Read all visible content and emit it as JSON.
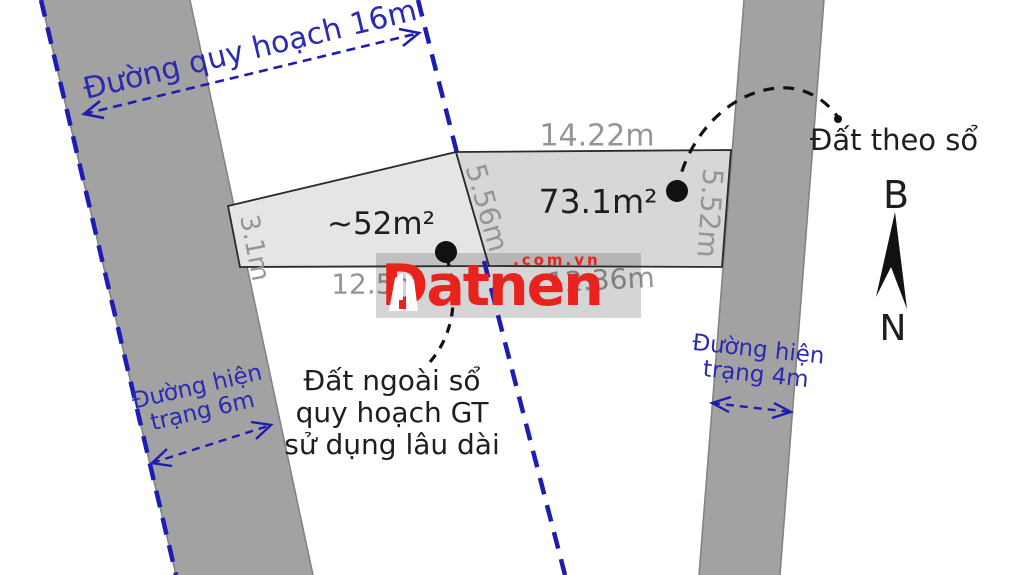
{
  "watermark": {
    "brand": "Datnen",
    "domain": ".com.vn"
  },
  "compass": {
    "north_label": "B",
    "south_label": "N"
  },
  "roads": {
    "planned_road": {
      "label": "Đường quy hoạch 16m"
    },
    "existing_road_left": {
      "lines": [
        "Đường hiện",
        "trạng 6m"
      ]
    },
    "existing_road_right": {
      "lines": [
        "Đường hiện",
        "trạng 4m"
      ]
    }
  },
  "parcels": {
    "outside_certificate": {
      "area": "~52m²",
      "note_lines": [
        "Đất ngoài sổ",
        "quy hoạch GT",
        "sử dụng lâu dài"
      ],
      "edge_left": "3.1m",
      "edge_right": "5.56m",
      "edge_bottom": "12.5m"
    },
    "per_certificate": {
      "area": "73.1m²",
      "label": "Đất theo sổ",
      "edge_top": "14.22m",
      "edge_right": "5.52m",
      "edge_bottom": "12.36m"
    }
  },
  "colors": {
    "road_fill": "#a2a2a2",
    "parcel_outside_fill": "#e5e5e5",
    "parcel_certificate_fill": "#d7d7d7",
    "planning_line_blue": "#1d1db0",
    "dimension_gray": "#959595",
    "logo_red": "#e8231e"
  }
}
